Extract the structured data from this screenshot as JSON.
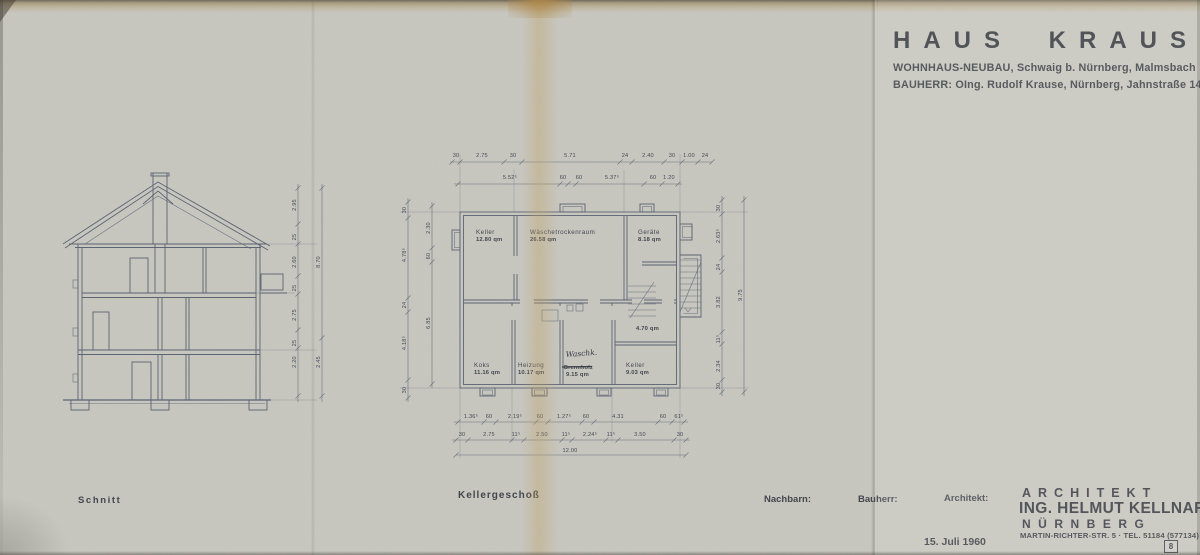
{
  "sheet": {
    "title": "HAUS KRAUSE",
    "project_line": "WOHNHAUS-NEUBAU, Schwaig b. Nürnberg, Malmsbach",
    "client_line": "BAUHERR: OIng. Rudolf Krause, Nürnberg, Jahnstraße 14",
    "date": "15. Juli 1960",
    "sheet_number": "8"
  },
  "architect": {
    "role": "ARCHITEKT",
    "name": "ING. HELMUT KELLNAR",
    "city": "NÜRNBERG",
    "address": "MARTIN-RICHTER-STR. 5 · TEL. 51184 (577134)"
  },
  "footer": {
    "section_label": "Schnitt",
    "plan_label": "Kellergeschoß",
    "neighbors_label": "Nachbarn:",
    "client_label": "Bauherr:",
    "architect_label": "Architekt:"
  },
  "plan": {
    "rooms": {
      "keller1": {
        "name": "Keller",
        "area": "12.80 qm"
      },
      "waesche": {
        "name": "Wäschetrockenraum",
        "area": "26.58 qm"
      },
      "geraete": {
        "name": "Geräte",
        "area": "8.18 qm"
      },
      "koks": {
        "name": "Koks",
        "area": "11.16 qm"
      },
      "heizung": {
        "name": "Heizung",
        "area": "10.17 qm"
      },
      "waschkueche": {
        "handwritten": "Waschk.",
        "struck": "Brennholz",
        "area": "9.15 qm"
      },
      "keller2": {
        "name": "Keller",
        "area": "9.03 qm"
      },
      "flur": {
        "area": "4.70 qm"
      }
    },
    "dims": {
      "top1": [
        "30",
        "2.75",
        "30",
        "5.71",
        "24",
        "2.40",
        "30",
        "1.00",
        "24"
      ],
      "top2": [
        "5.52⁵",
        "60",
        "60",
        "5.37⁵",
        "60",
        "1.20"
      ],
      "bottom1": [
        "1.36⁵",
        "60",
        "2.19⁵",
        "60",
        "1.27⁵",
        "60",
        "4.31",
        "60",
        "61⁵"
      ],
      "bottom2": [
        "30",
        "2.75",
        "11⁵",
        "2.50",
        "11⁵",
        "2.24⁵",
        "11⁵",
        "3.50",
        "30"
      ],
      "total": "12.00",
      "left_outer": [
        "30",
        "4.78⁵",
        "24",
        "4.18⁵",
        "30"
      ],
      "left_inner": [
        "2.30",
        "60",
        "6.85"
      ],
      "right_inner": [
        "30",
        "2.63⁵",
        "24",
        "3.82",
        "11⁵",
        "2.34",
        "30"
      ],
      "right_total": "9.75"
    }
  },
  "section": {
    "dims_inner": [
      "2.95",
      "25",
      "2.60",
      "25",
      "2.75",
      "25",
      "2.20"
    ],
    "dims_outer": [
      "8.70",
      "2.45"
    ]
  },
  "colors": {
    "paper": "#c8c7c0",
    "ink": "#566070",
    "text": "#3a3d45",
    "fold_stain": "#c2a066"
  }
}
